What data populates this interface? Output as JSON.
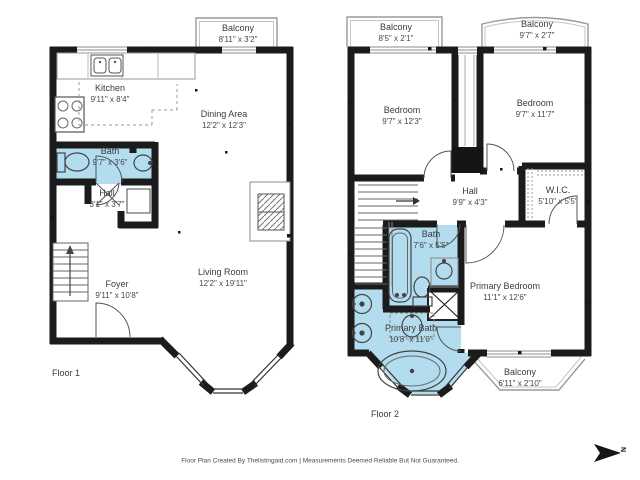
{
  "page": {
    "footer": "Floor Plan Created By Thelistingaid.com | Measurements Deemed Reliable But Not Guaranteed.",
    "compass": "N"
  },
  "colors": {
    "wall": "#1b1b1b",
    "bath_fill": "#b3dcee",
    "railing": "#9a9a9a",
    "label_text": "#3b3b3b"
  },
  "floor1": {
    "label": "Floor 1",
    "rooms": {
      "balcony": {
        "name": "Balcony",
        "dims": "8'11\" x 3'2\""
      },
      "kitchen": {
        "name": "Kitchen",
        "dims": "9'11\" x 8'4\""
      },
      "dining": {
        "name": "Dining Area",
        "dims": "12'2\" x 12'3\""
      },
      "bath": {
        "name": "Bath",
        "dims": "9'7\" x 3'6\""
      },
      "hall": {
        "name": "Hall",
        "dims": "3'1\" x 3'7\""
      },
      "foyer": {
        "name": "Foyer",
        "dims": "9'11\" x 10'8\""
      },
      "living": {
        "name": "Living Room",
        "dims": "12'2\" x 19'11\""
      }
    }
  },
  "floor2": {
    "label": "Floor 2",
    "rooms": {
      "balcony_left": {
        "name": "Balcony",
        "dims": "8'5\" x 2'1\""
      },
      "balcony_right": {
        "name": "Balcony",
        "dims": "9'7\" x 2'7\""
      },
      "bedroom_left": {
        "name": "Bedroom",
        "dims": "9'7\" x 12'3\""
      },
      "bedroom_right": {
        "name": "Bedroom",
        "dims": "9'7\" x 11'7\""
      },
      "hall": {
        "name": "Hall",
        "dims": "9'9\" x 4'3\""
      },
      "wic": {
        "name": "W.I.C.",
        "dims": "5'10\" x 5'5\""
      },
      "bath": {
        "name": "Bath",
        "dims": "7'6\" x 5'5\""
      },
      "primary_bath": {
        "name": "Primary Bath",
        "dims": "10'8\" x 11'0\""
      },
      "primary_bedroom": {
        "name": "Primary Bedroom",
        "dims": "11'1\" x 12'6\""
      },
      "balcony_bottom": {
        "name": "Balcony",
        "dims": "6'11\" x 2'10\""
      }
    }
  }
}
